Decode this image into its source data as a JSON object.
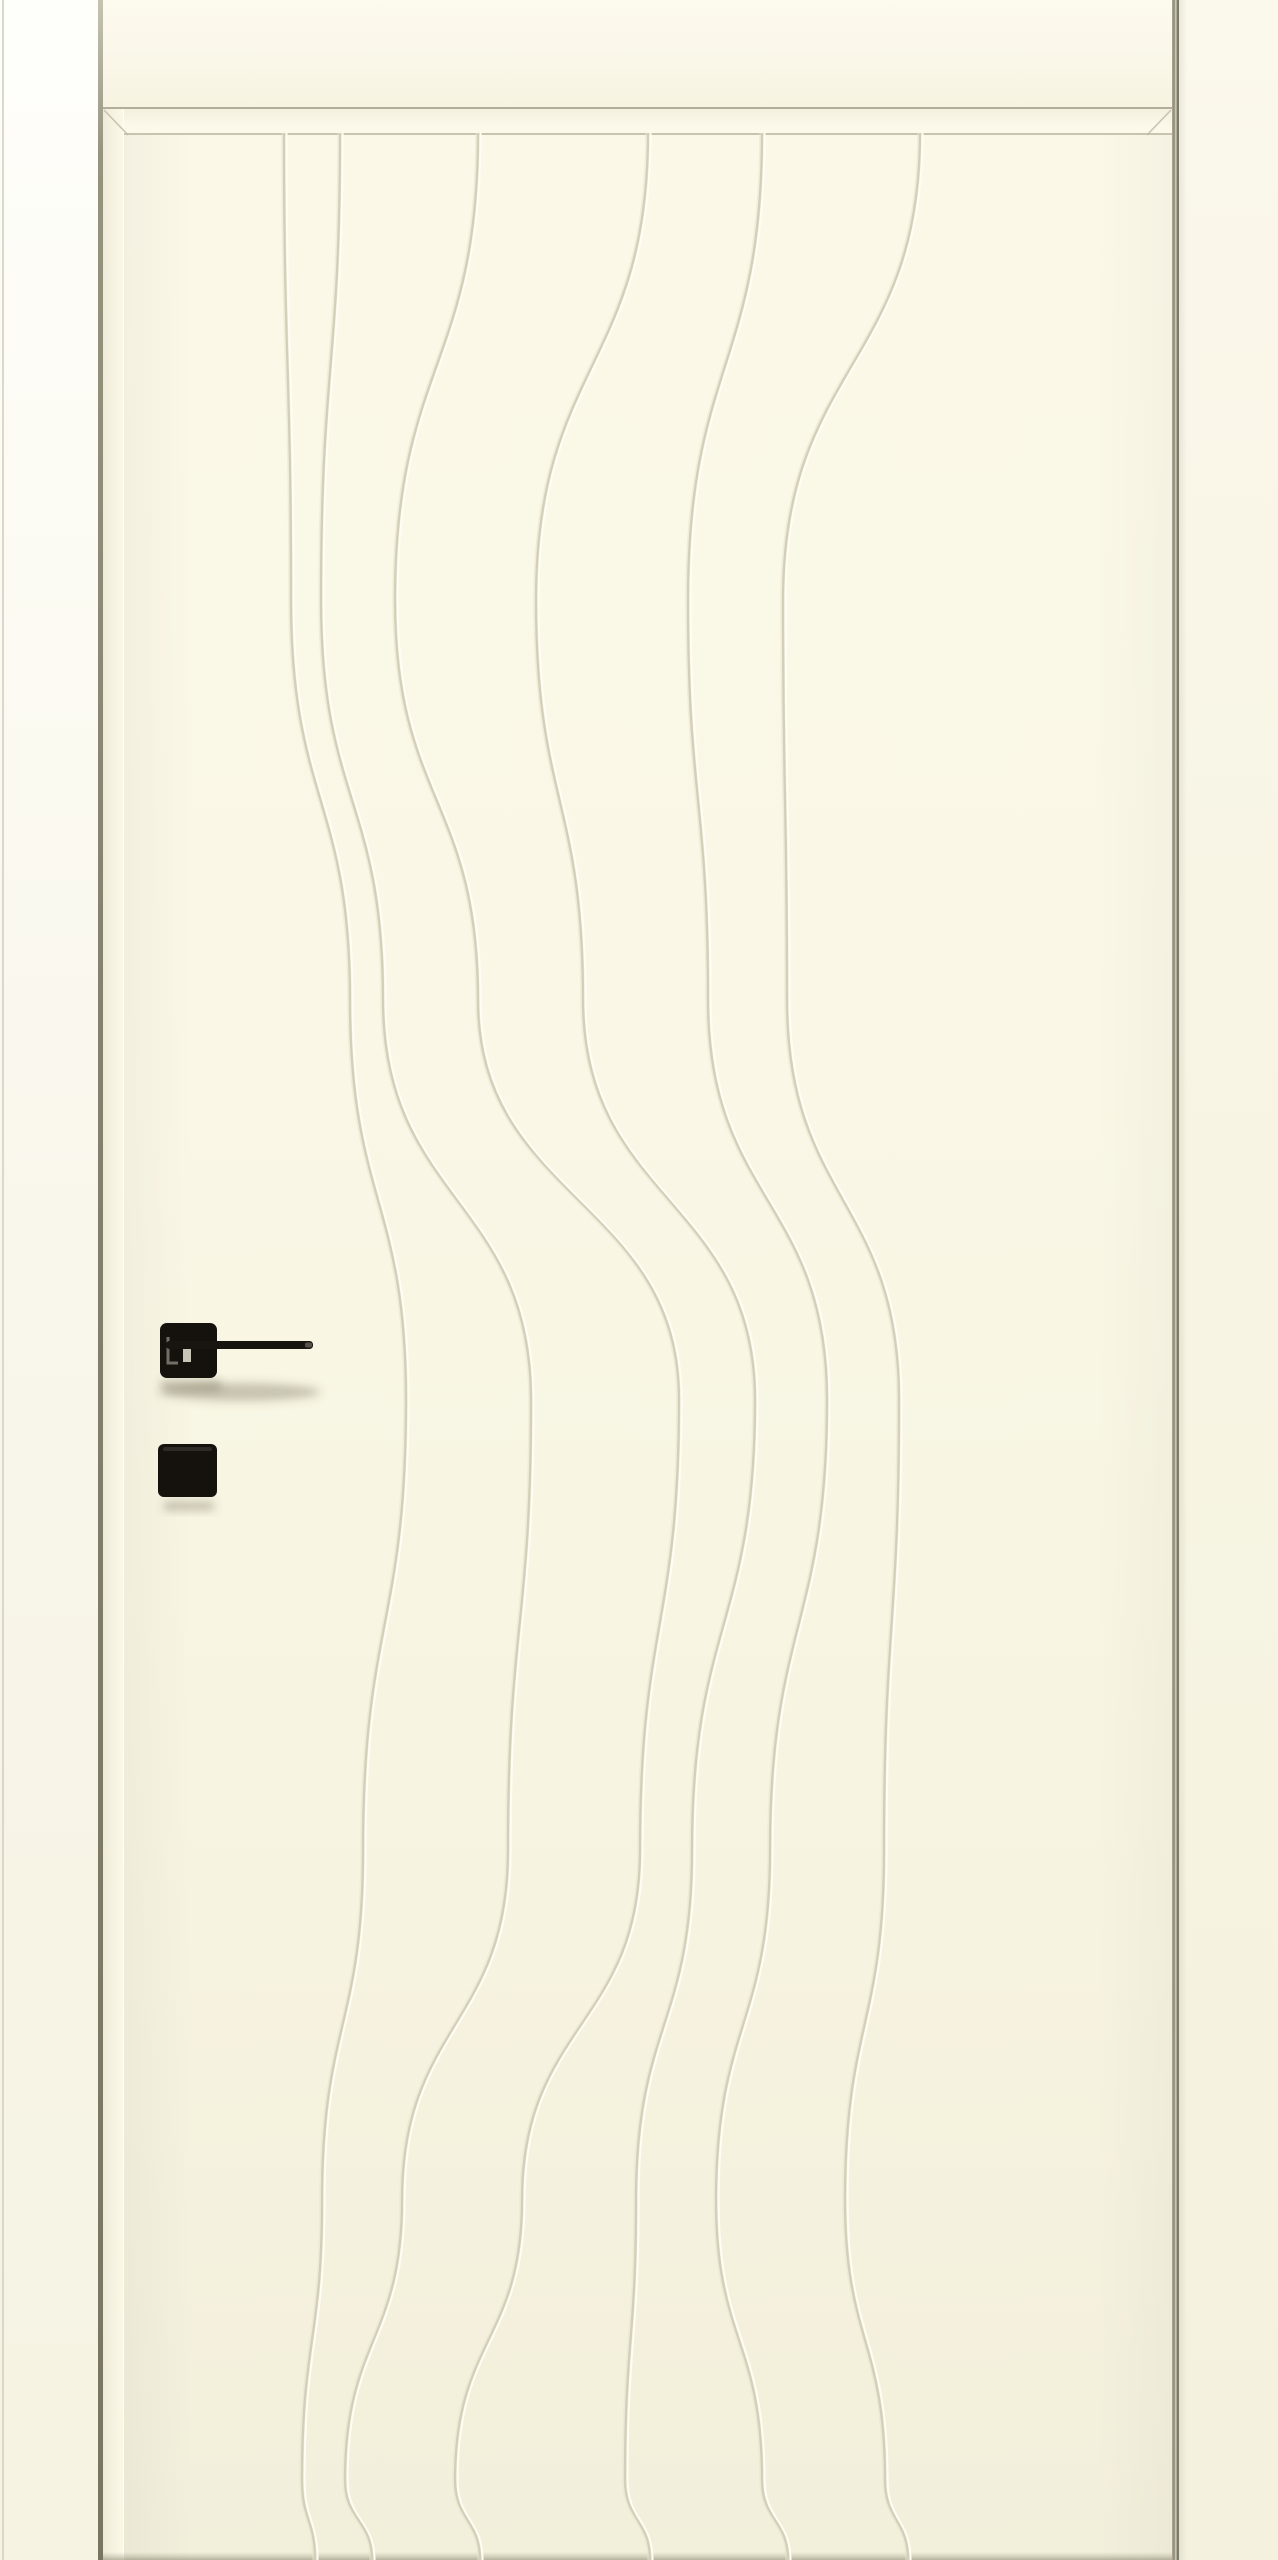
{
  "meta": {
    "type": "product-photo",
    "subject": "Cream painted interior door with flowing wavy groove pattern, black square-rosette lever handle and matching square privacy escutcheon, shown in frame",
    "orientation": "portrait"
  },
  "scene": {
    "width": 1278,
    "height": 2560
  },
  "objects": [
    "left-wall-jamb",
    "door-frame-head",
    "door-leaf",
    "wave-grooves",
    "door-handle-lever",
    "privacy-escutcheon",
    "right-casing"
  ],
  "handle": {
    "style": "square rosette with long thin lever",
    "finish": "matte black",
    "lever_direction": "right"
  },
  "colors": {
    "face-cream": "#f8f5e3",
    "groove-soft": "#e8e4d0",
    "groove-shadow": "#d2ceb7",
    "groove-highlight": "#fffef5",
    "edge-line": "#bdbaa7",
    "gap-dark": "#7c7966",
    "handle-black": "#15120e",
    "handle-reflection": "#8a857c",
    "shadow-soft": "rgba(85,80,58,0.30)"
  },
  "waves": {
    "count": 6,
    "paths": [
      "M284 133 C284 366 291 366 291 600 C291 800 350 800 350 1000 C350 1200 406 1200 406 1400 C406 1625 363 1625 363 1850 C363 2025 322 2025 322 2200 C322 2340 302 2340 302 2480 C302 2520 315 2520 315 2560",
      "M340 133 C340 366 321 366 321 600 C321 800 383 800 383 1000 C383 1200 531 1200 531 1400 C531 1625 508 1625 508 1850 C508 2025 402 2025 402 2200 C402 2340 345 2340 345 2480 C345 2520 372 2520 372 2560",
      "M478 133 C478 366 395 366 395 600 C395 800 478 800 478 1000 C478 1200 679 1200 679 1400 C679 1625 640 1625 640 1850 C640 2025 522 2025 522 2200 C522 2340 455 2340 455 2480 C455 2520 480 2520 480 2560",
      "M648 133 C648 366 536 366 536 600 C536 800 583 800 583 1000 C583 1200 755 1200 755 1400 C755 1625 692 1625 692 1850 C692 2025 636 2025 636 2200 C636 2340 625 2340 625 2480 C625 2520 650 2520 650 2560",
      "M762 133 C762 366 688 366 688 600 C688 800 708 800 708 1000 C708 1200 827 1200 827 1400 C827 1625 770 1625 770 1850 C770 2025 716 2025 716 2200 C716 2340 762 2340 762 2480 C762 2520 788 2520 788 2560",
      "M920 133 C920 366 783 366 783 600 C783 800 787 800 787 1000 C787 1200 899 1200 899 1400 C899 1625 884 1625 884 1850 C884 2025 845 2025 845 2200 C845 2340 885 2340 885 2480 C885 2520 908 2520 908 2560"
    ]
  }
}
